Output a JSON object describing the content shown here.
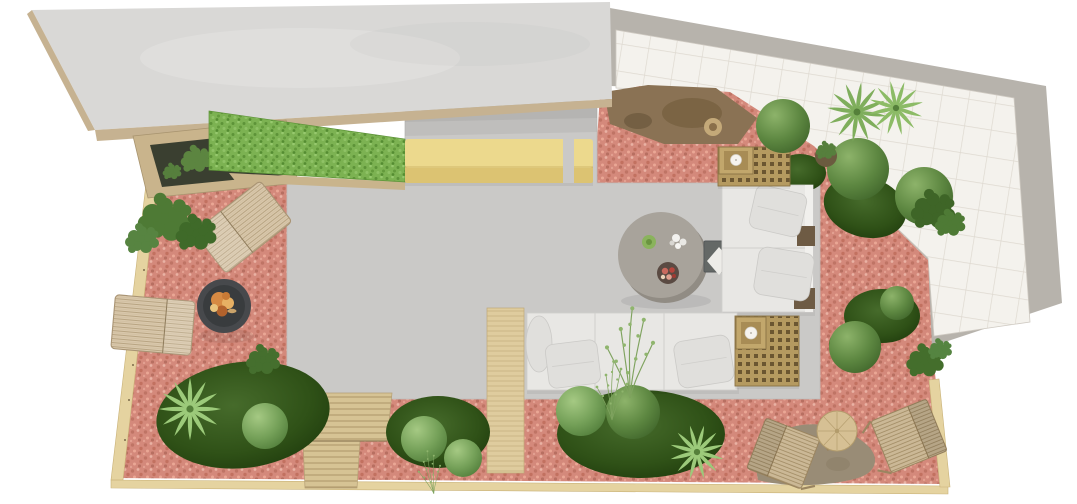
{
  "scene": {
    "kind": "3d-top-view-landscape-render",
    "description": "Top-down 3D render of a terrace garden landscaping design on a white background",
    "canvas": {
      "width": 1077,
      "height": 504
    },
    "background": "#ffffff"
  },
  "colors": {
    "page": "#ffffff",
    "slab": "#d9d8d6",
    "fascia": "#c6b291",
    "planterWood": "#c9b48c",
    "planterSoil": "#3a3f30",
    "hedge": "#7cb252",
    "hedgeDark": "#5d9338",
    "hedgeLight": "#97c96e",
    "bench": "#ecd98d",
    "benchFront": "#dcc372",
    "patio": "#cac9c7",
    "patioEdge": "#bdbcba",
    "gravel": "#d4897b",
    "gravelDark": "#bf7465",
    "gravelLight": "#e9b2a4",
    "tile": "#f4f2ed",
    "tileLine": "#ded9d0",
    "band": "#b7b3ac",
    "dirt": "#8a7254",
    "rock": "#6e5a3e",
    "border": "#e5d3a0",
    "borderEdge": "#c9b278",
    "steps": "#d6c394",
    "stepLine": "#ac9568",
    "walkway": "#dfcc9e",
    "sofa": "#e8e7e4",
    "sofaLine": "#d0cfcc",
    "pillow": "#e0dfdc",
    "woodArm": "#6e5b44",
    "lattice": "#b59a60",
    "latticeHole": "#6b5631",
    "candleBox": "#c2a76c",
    "candle": "#f6f3ee",
    "tableTop": "#a8a39b",
    "tableShade": "#918c84",
    "sideTable": "#646866",
    "diamond": "#edece8",
    "firePit": "#47494c",
    "firePitInner": "#393c3e",
    "flame": "#d68a43",
    "wicker": "#d9c8ac",
    "wickerLine": "#b5a07d",
    "chairWood": "#cbb896",
    "chairLine": "#a08a62",
    "pouf": "#d6c094",
    "poufLine": "#b39c6c",
    "stone": "#998c76",
    "moss": "#2f5117",
    "topiary": "#74a058",
    "topiaryDark": "#5d8741",
    "bush": "#4e7a35",
    "palm": "#8cbb66",
    "fern": "#9cca7a"
  },
  "objects": {
    "structures": [
      "concrete canopy slab",
      "timber fascia edge",
      "white tiled terrace",
      "concrete terrace border band",
      "polished concrete patio",
      "timber perimeter edging",
      "timber steps",
      "timber plank walkway",
      "soil and rock bed",
      "pink gravel ground cover"
    ],
    "planting": [
      "artificial boxwood hedge",
      "timber planter with shrubs",
      "clipped topiary spheres",
      "moss ground mounds",
      "leafy shrubs",
      "palm plants",
      "ornamental grass plumes",
      "agave rosette"
    ],
    "furniture": [
      "yellow upholstered bench",
      "L-shaped white modular sofa",
      "white seat pillows",
      "timber lattice side cubes",
      "candle trays",
      "dark metal side table",
      "round concrete coffee table",
      "decorative plates and flower bowl",
      "round fire pit with burning logs",
      "woven rattan loungers",
      "slatted timber deck chairs",
      "round rattan pouf table",
      "natural stone landing pad"
    ],
    "counts": {
      "topiary_spheres": 10,
      "moss_mounds": 6,
      "palm_plants": 4,
      "deck_chairs": 2,
      "rattan_loungers": 2,
      "sofa_seat_modules": 5,
      "lattice_cubes": 2,
      "candles": 2
    }
  }
}
